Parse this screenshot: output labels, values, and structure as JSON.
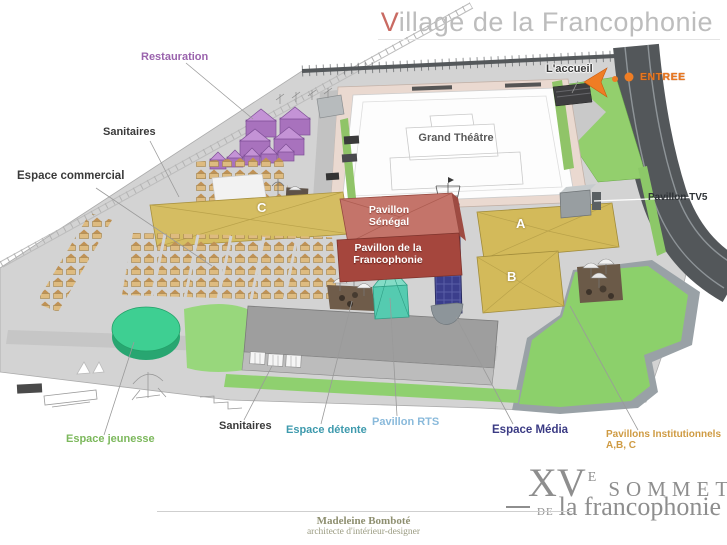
{
  "title": {
    "v": "V",
    "rest": "illage de la Francophonie"
  },
  "map_labels": {
    "restauration": "Restauration",
    "sanitaires_top": "Sanitaires",
    "espace_commercial": "Espace commercial",
    "accueil": "L'accueil",
    "entree": "ENTREE",
    "grand_theatre": "Grand Théâtre",
    "pavillon_senegal_line1": "Pavillon",
    "pavillon_senegal_line2": "Sénégal",
    "pavillon_francophonie_line1": "Pavillon de la",
    "pavillon_francophonie_line2": "Francophonie",
    "pavillon_tv5": "Pavillon TV5",
    "building_a": "A",
    "building_b": "B",
    "building_c": "C",
    "espace_jeunesse": "Espace jeunesse",
    "sanitaires_bottom": "Sanitaires",
    "espace_detente": "Espace détente",
    "pavillon_rts": "Pavillon RTS",
    "espace_media": "Espace Média",
    "pavillons_institutionnels_line1": "Pavillons Institutionnels",
    "pavillons_institutionnels_line2": "A,B, C"
  },
  "logo": {
    "roman": "XV",
    "sup": "E",
    "word": "SOMMET",
    "de": "DE",
    "name": "la francophonie"
  },
  "credit": {
    "name": "Madeleine Bomboté",
    "role": "architecte d'intérieur-designer"
  },
  "colors": {
    "title_gray": "#bdbdbd",
    "title_accent": "#c96a62",
    "restauration_purple": "#9a63ad",
    "entree_orange": "#e8761e",
    "jeunesse_green": "#7cb85c",
    "detente_teal": "#3e9aad",
    "rts_blue": "#8abadb",
    "media_navy": "#3b3b84",
    "institutionnels_orange": "#cf9b43",
    "tents_purple": "#a872bd",
    "stalls_tan": "#debb80",
    "buildings_tan": "#d3ba5a",
    "senegal_salmon": "#c4746a",
    "francophonie_red": "#a5463d",
    "rts_tent_teal": "#55cbb0",
    "media_blue": "#3b3e8c",
    "grass_green": "#8fd06f",
    "road_gray": "#53575a",
    "ground_gray": "#d3d3d3",
    "logo_gray": "#8e8e8e"
  }
}
